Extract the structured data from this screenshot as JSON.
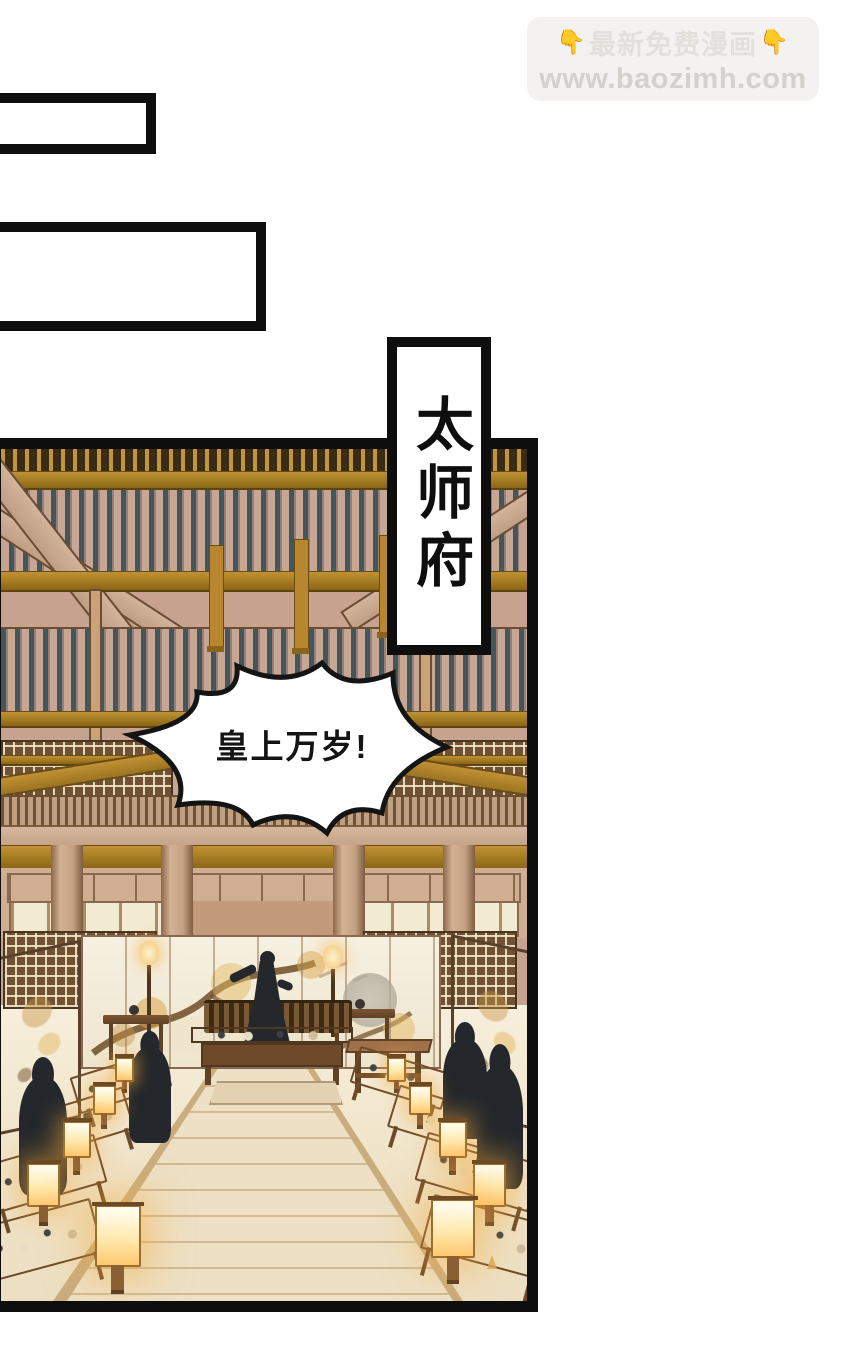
{
  "watermark": {
    "pointer_icon": "👇",
    "title": "最新免费漫画",
    "url": "www.baozimh.com"
  },
  "panel": {
    "location_label": "太师府",
    "speech_bubble_text": "皇上万岁!"
  },
  "colors": {
    "panel_border": "#0e0e0e",
    "ceiling_wood": "#c7a28e",
    "beam_gold": "#a87f22",
    "rafter_teal": "#42565c",
    "floor_cream": "#f4ebd7",
    "screen_cream": "#f3ecda",
    "silhouette": "#24282c",
    "lantern_glow": "#ffd98e",
    "watermark_bg": "#f3f2f0",
    "watermark_text": "#d4d1cc"
  }
}
